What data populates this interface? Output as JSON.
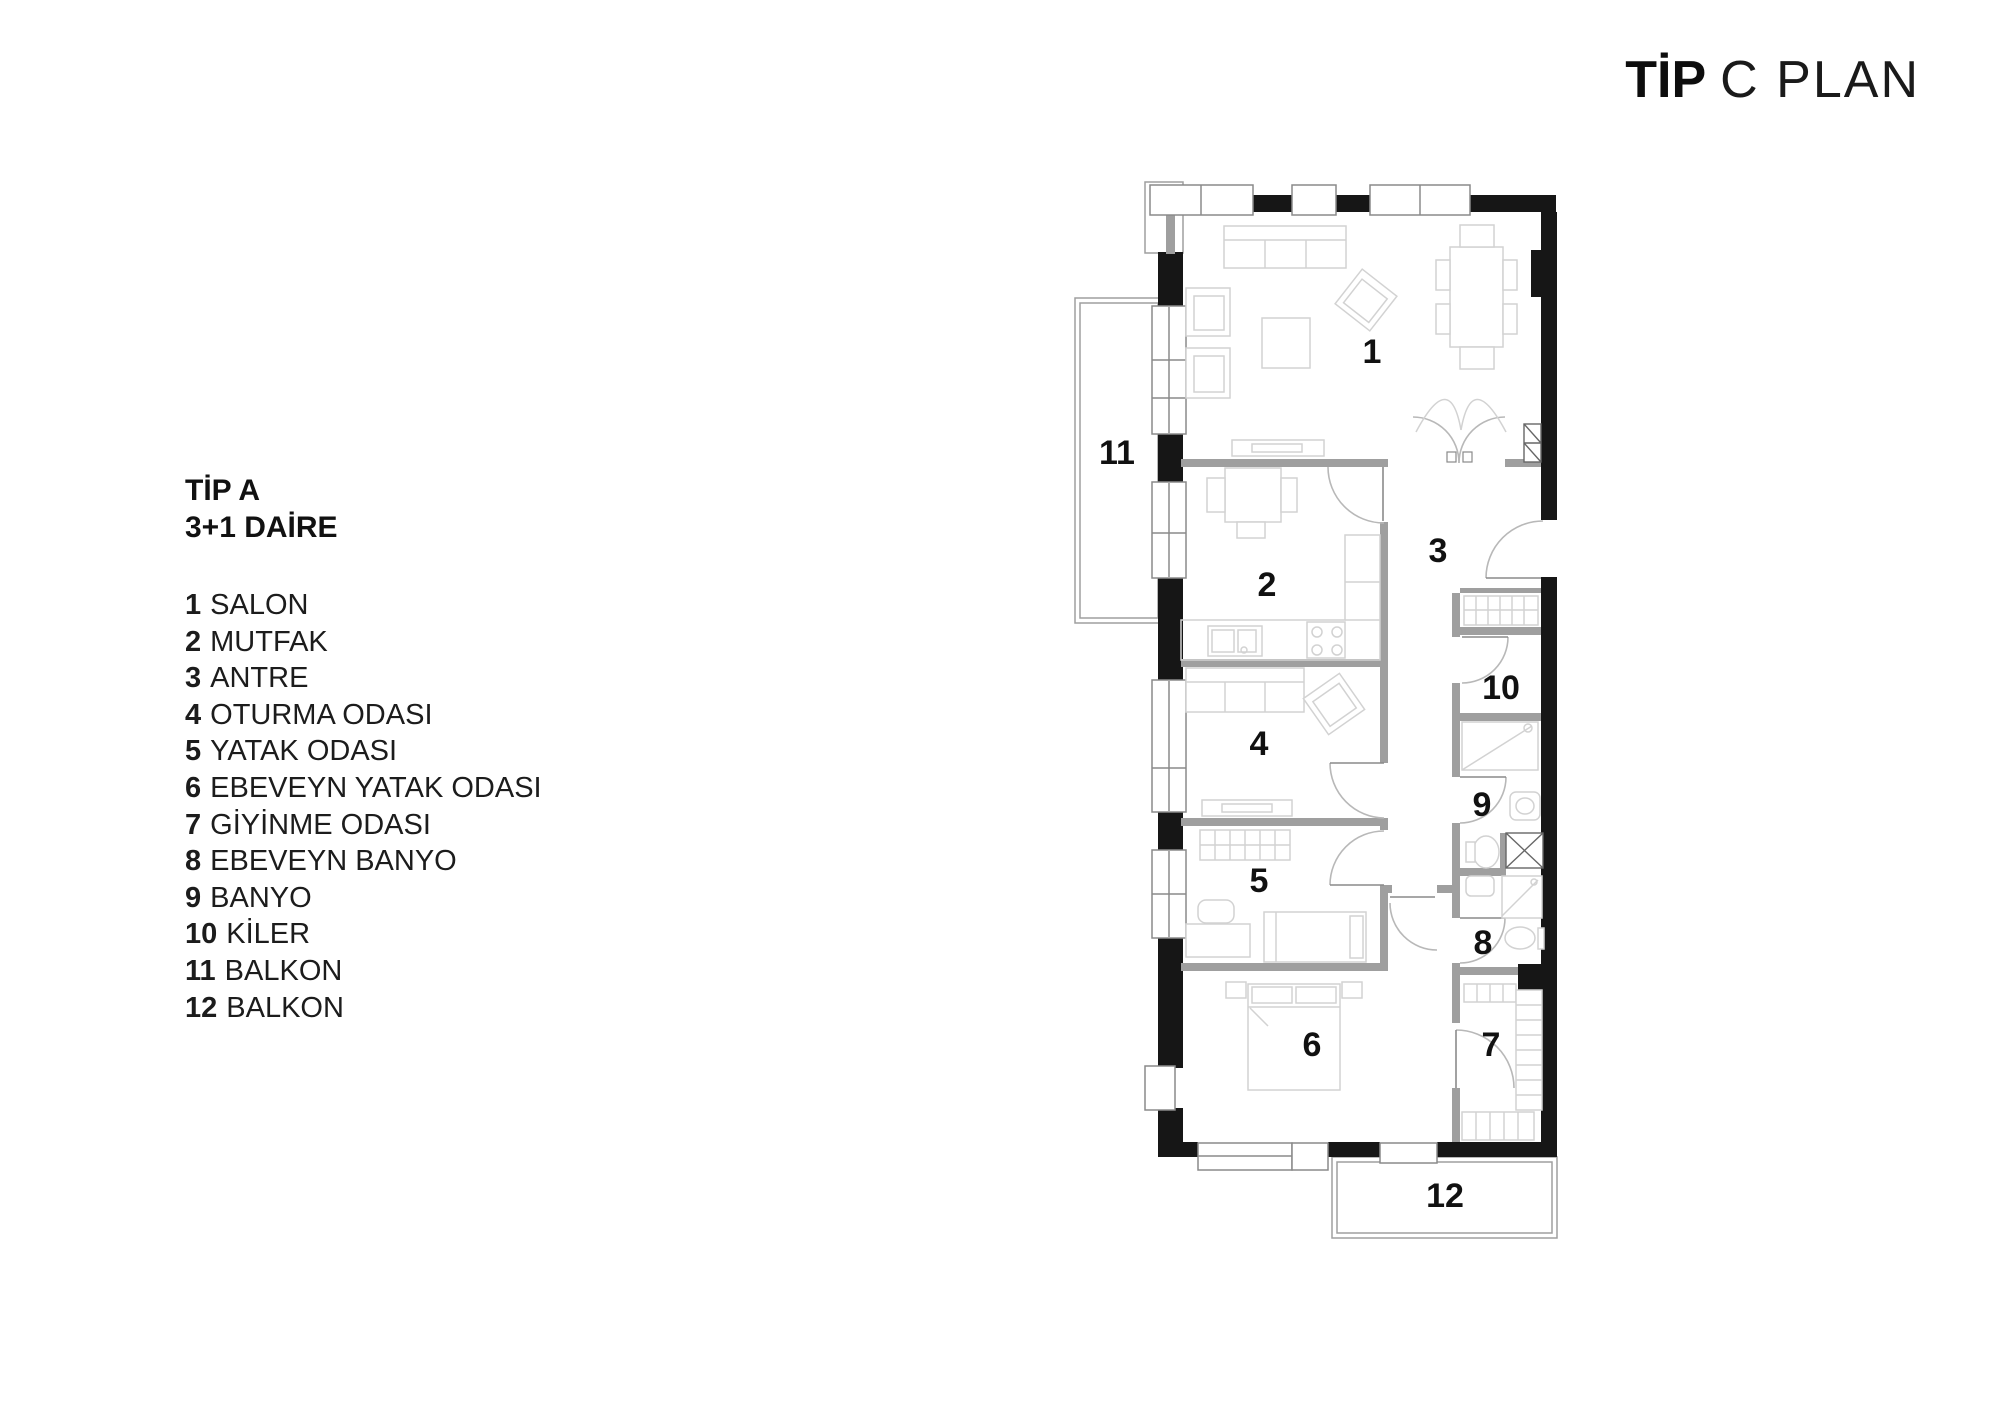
{
  "title": {
    "type": "TİP",
    "plan": "C PLAN"
  },
  "legend": {
    "heading_line1": "TİP A",
    "heading_line2": "3+1 DAİRE",
    "items": [
      {
        "num": "1",
        "name": "SALON"
      },
      {
        "num": "2",
        "name": "MUTFAK"
      },
      {
        "num": "3",
        "name": "ANTRE"
      },
      {
        "num": "4",
        "name": "OTURMA ODASI"
      },
      {
        "num": "5",
        "name": "YATAK ODASI"
      },
      {
        "num": "6",
        "name": "EBEVEYN YATAK ODASI"
      },
      {
        "num": "7",
        "name": "GİYİNME ODASI"
      },
      {
        "num": "8",
        "name": "EBEVEYN BANYO"
      },
      {
        "num": "9",
        "name": "BANYO"
      },
      {
        "num": "10",
        "name": "KİLER"
      },
      {
        "num": "11",
        "name": "BALKON"
      },
      {
        "num": "12",
        "name": "BALKON"
      }
    ]
  },
  "plan": {
    "rooms": [
      {
        "num": "1"
      },
      {
        "num": "2"
      },
      {
        "num": "3"
      },
      {
        "num": "4"
      },
      {
        "num": "5"
      },
      {
        "num": "6"
      },
      {
        "num": "7"
      },
      {
        "num": "8"
      },
      {
        "num": "9"
      },
      {
        "num": "10"
      },
      {
        "num": "11"
      },
      {
        "num": "12"
      }
    ],
    "colors": {
      "wall": "#161616",
      "partition": "#9f9f9f",
      "furniture": "#d2d2d2",
      "door": "#b8b8b8",
      "window": "#8a8a8a",
      "hatch": "#666666"
    }
  }
}
